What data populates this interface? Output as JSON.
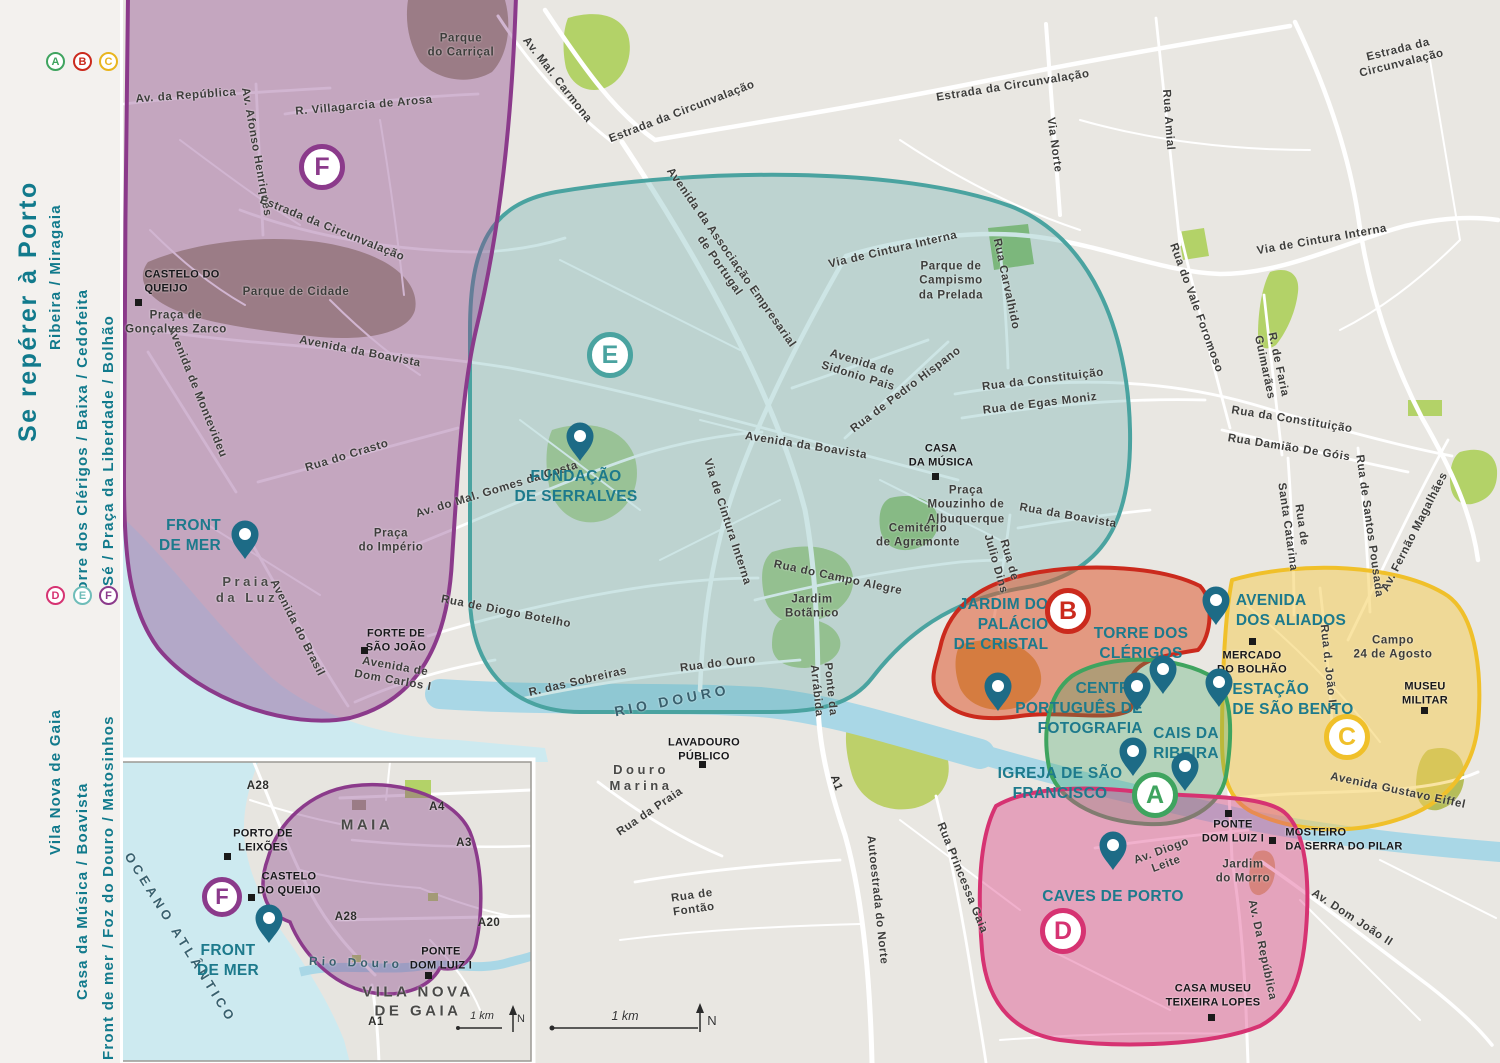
{
  "sidebar": {
    "title": "Se repérer à Porto",
    "legend_top": [
      {
        "letter": "A",
        "text": "Ribeira / Miragaia",
        "color": "#3fa45f"
      },
      {
        "letter": "B",
        "text": "Torre dos Clérigos / Baixa / Cedofeita",
        "color": "#cb2a1d"
      },
      {
        "letter": "C",
        "text": "Sé / Praça da Liberdade / Bolhão",
        "color": "#e9b51e"
      }
    ],
    "legend_bottom": [
      {
        "letter": "D",
        "text": "Vila Nova de Gaia",
        "color": "#d63372"
      },
      {
        "letter": "E",
        "text": "Casa da Música / Boavista",
        "color": "#6fbdb9"
      },
      {
        "letter": "F",
        "text": "Front de mer / Foz do Douro / Matosinhos",
        "color": "#8b3a8b"
      }
    ]
  },
  "map": {
    "colors": {
      "background": "#e9e7e2",
      "road": "#ffffff",
      "river": "#a9d7e6",
      "ocean": "#cdeaf0",
      "park_olive": "#a6a083",
      "park_green": "#b3d268",
      "pin": "#1d6b86",
      "poi_text": "#1d7a8c",
      "title_text": "#117a8c"
    },
    "zones": [
      {
        "id": "A",
        "name": "Ribeira / Miragaia",
        "color": "#3fa45f",
        "fill": "rgba(63,164,95,0.30)"
      },
      {
        "id": "B",
        "name": "Torre dos Clérigos / Baixa / Cedofeita",
        "color": "#cb2a1d",
        "fill": "rgba(222,90,50,0.55)"
      },
      {
        "id": "C",
        "name": "Sé / Praça da Liberdade / Bolhão",
        "color": "#f0c02a",
        "fill": "rgba(244,205,90,0.55)"
      },
      {
        "id": "D",
        "name": "Vila Nova de Gaia",
        "color": "#d63372",
        "fill": "rgba(221,70,135,0.42)"
      },
      {
        "id": "E",
        "name": "Casa da Música / Boavista",
        "color": "#4aa3a0",
        "fill": "rgba(74,163,160,0.28)"
      },
      {
        "id": "F",
        "name": "Front de mer / Foz do Douro / Matosinhos",
        "color": "#8b3a8b",
        "fill": "rgba(140,70,140,0.40)"
      }
    ],
    "badges": [
      {
        "zone": "F",
        "x": 322,
        "y": 167,
        "size": 46
      },
      {
        "zone": "E",
        "x": 610,
        "y": 355,
        "size": 46
      },
      {
        "zone": "B",
        "x": 1068,
        "y": 611,
        "size": 46
      },
      {
        "zone": "A",
        "x": 1155,
        "y": 795,
        "size": 46
      },
      {
        "zone": "C",
        "x": 1347,
        "y": 737,
        "size": 46
      },
      {
        "zone": "D",
        "x": 1063,
        "y": 931,
        "size": 46
      },
      {
        "zone": "F",
        "x": 222,
        "y": 897,
        "size": 40
      }
    ],
    "pins": [
      {
        "n": "pin-front-de-mer",
        "x": 245,
        "y": 560
      },
      {
        "n": "pin-fundacao-serralves",
        "x": 580,
        "y": 462
      },
      {
        "n": "pin-jardim-palacio-cristal",
        "x": 998,
        "y": 712
      },
      {
        "n": "pin-centro-portugues-fotografia",
        "x": 1137,
        "y": 712
      },
      {
        "n": "pin-torre-dos-clerigos",
        "x": 1163,
        "y": 695
      },
      {
        "n": "pin-avenida-dos-aliados",
        "x": 1216,
        "y": 626
      },
      {
        "n": "pin-estacao-sao-bento",
        "x": 1219,
        "y": 708
      },
      {
        "n": "pin-igreja-sao-francisco",
        "x": 1133,
        "y": 777
      },
      {
        "n": "pin-cais-da-ribeira",
        "x": 1185,
        "y": 792
      },
      {
        "n": "pin-caves-de-porto",
        "x": 1113,
        "y": 871
      },
      {
        "n": "pin-front-de-mer-inset",
        "x": 269,
        "y": 944
      }
    ],
    "squares": [
      {
        "n": "sq-castelo-do-queijo",
        "x": 138,
        "y": 302
      },
      {
        "n": "sq-forte-sao-joao",
        "x": 364,
        "y": 650
      },
      {
        "n": "sq-casa-da-musica",
        "x": 935,
        "y": 476
      },
      {
        "n": "sq-lavadouro-publico",
        "x": 702,
        "y": 764
      },
      {
        "n": "sq-mercado-bolhao",
        "x": 1252,
        "y": 641
      },
      {
        "n": "sq-museu-militar",
        "x": 1424,
        "y": 710
      },
      {
        "n": "sq-ponte-dom-luiz",
        "x": 1228,
        "y": 813
      },
      {
        "n": "sq-mosteiro-serra-pilar",
        "x": 1272,
        "y": 840
      },
      {
        "n": "sq-casa-museu-teixeira-lopes",
        "x": 1211,
        "y": 1017
      },
      {
        "n": "sq-porto-de-leixoes",
        "x": 227,
        "y": 856
      },
      {
        "n": "sq-castelo-queijo-inset",
        "x": 251,
        "y": 897
      },
      {
        "n": "sq-ponte-dom-luiz-inset",
        "x": 428,
        "y": 975
      }
    ],
    "labels": [
      {
        "t": "Av. Mal. Carmona",
        "x": 557,
        "y": 80,
        "r": 52
      },
      {
        "t": "Estrada da Circunvalação",
        "x": 682,
        "y": 112,
        "r": -21
      },
      {
        "t": "Estrada da Circunvalação",
        "x": 1013,
        "y": 86,
        "r": -9
      },
      {
        "t": "Estrada da\nCircunvalação",
        "x": 1400,
        "y": 57,
        "r": -14,
        "a": "center"
      },
      {
        "t": "Via Norte",
        "x": 1054,
        "y": 145,
        "r": 82
      },
      {
        "t": "Rua Amial",
        "x": 1168,
        "y": 120,
        "r": 86
      },
      {
        "t": "Via de Cintura Interna",
        "x": 1322,
        "y": 240,
        "r": -10
      },
      {
        "t": "Rua do Vale Foromoso",
        "x": 1196,
        "y": 308,
        "r": 70
      },
      {
        "t": "R. de Faria\nGuimarães",
        "x": 1271,
        "y": 366,
        "r": 78,
        "a": "center"
      },
      {
        "t": "Rua da Constituição",
        "x": 1292,
        "y": 420,
        "r": 9
      },
      {
        "t": "Rua Damião De Góis",
        "x": 1289,
        "y": 448,
        "r": 9
      },
      {
        "t": "Rua de\nSanta Catarina",
        "x": 1294,
        "y": 526,
        "r": 82,
        "a": "center"
      },
      {
        "t": "Rua de Santos Pousada",
        "x": 1369,
        "y": 526,
        "r": 82
      },
      {
        "t": "Av. Fernão Magalhães",
        "x": 1415,
        "y": 532,
        "r": -63
      },
      {
        "t": "Rua Carvalhido",
        "x": 1006,
        "y": 284,
        "r": 78
      },
      {
        "t": "Via de Cintura Interna",
        "x": 893,
        "y": 250,
        "r": -13
      },
      {
        "t": "Avenida da Associação Empresarial\nde Portugal",
        "x": 725,
        "y": 262,
        "r": 55,
        "a": "center"
      },
      {
        "t": "Avenida de\nSidonio Pais",
        "x": 860,
        "y": 370,
        "r": 17,
        "a": "center"
      },
      {
        "t": "Rua de Pedro Hispano",
        "x": 906,
        "y": 390,
        "r": -37
      },
      {
        "t": "Rua da Constituição",
        "x": 1043,
        "y": 380,
        "r": -7
      },
      {
        "t": "Rua de Egas Moniz",
        "x": 1040,
        "y": 404,
        "r": -7
      },
      {
        "t": "Avenida da Boavista",
        "x": 806,
        "y": 446,
        "r": 9
      },
      {
        "t": "Rua da Boavista",
        "x": 1068,
        "y": 516,
        "r": 10
      },
      {
        "t": "Rua de\nJulio Dins",
        "x": 1002,
        "y": 562,
        "r": 74,
        "a": "center"
      },
      {
        "t": "Via de Cintura Interna",
        "x": 727,
        "y": 522,
        "r": 72
      },
      {
        "t": "Rua do Campo Alegre",
        "x": 838,
        "y": 578,
        "r": 12
      },
      {
        "t": "R. das Sobreiras",
        "x": 578,
        "y": 682,
        "r": -13
      },
      {
        "t": "Rua do Ouro",
        "x": 718,
        "y": 664,
        "r": -7
      },
      {
        "t": "Avenida da Boavista",
        "x": 360,
        "y": 352,
        "r": 11
      },
      {
        "t": "Av. da República",
        "x": 186,
        "y": 96,
        "r": -4
      },
      {
        "t": "Av. Afonso Henriques",
        "x": 256,
        "y": 152,
        "r": 80
      },
      {
        "t": "R. Villagarcia de Arosa",
        "x": 364,
        "y": 106,
        "r": -5
      },
      {
        "t": "Estrada da Circunvalação",
        "x": 332,
        "y": 229,
        "r": 22
      },
      {
        "t": "Avenida de Montevideu",
        "x": 197,
        "y": 392,
        "r": 68
      },
      {
        "t": "Rua do Crasto",
        "x": 347,
        "y": 456,
        "r": -17
      },
      {
        "t": "Av. do Mal. Gomes da Costa",
        "x": 497,
        "y": 490,
        "r": -17
      },
      {
        "t": "Avenida do Brasil",
        "x": 297,
        "y": 628,
        "r": 63
      },
      {
        "t": "Avenida de\nDom Carlos I",
        "x": 394,
        "y": 674,
        "r": 10,
        "a": "center"
      },
      {
        "t": "Rua de Diogo Botelho",
        "x": 506,
        "y": 612,
        "r": 11
      },
      {
        "t": "Ponte da\nArrábida",
        "x": 823,
        "y": 690,
        "r": 84,
        "a": "center"
      },
      {
        "t": "Rua da Praia",
        "x": 650,
        "y": 812,
        "r": -34
      },
      {
        "t": "Rua de\nFontão",
        "x": 693,
        "y": 903,
        "r": -8,
        "a": "center"
      },
      {
        "t": "A1",
        "x": 836,
        "y": 783,
        "r": 70,
        "k": "road"
      },
      {
        "t": "Autoestrada do Norte",
        "x": 877,
        "y": 900,
        "r": 84
      },
      {
        "t": "Rua Princessa Gaia",
        "x": 962,
        "y": 878,
        "r": 68
      },
      {
        "t": "Avenida Gustavo Eiffel",
        "x": 1398,
        "y": 791,
        "r": 12
      },
      {
        "t": "Rua d. João IV",
        "x": 1328,
        "y": 668,
        "r": 84
      },
      {
        "t": "Av. Diogo\nLeite",
        "x": 1164,
        "y": 858,
        "r": -20,
        "a": "center"
      },
      {
        "t": "Av. Da República",
        "x": 1262,
        "y": 950,
        "r": 78
      },
      {
        "t": "Av. Dom João II",
        "x": 1352,
        "y": 918,
        "r": 33
      },
      {
        "t": "Parque\ndo Carriçal",
        "x": 461,
        "y": 46,
        "a": "center"
      },
      {
        "t": "Parque de Cidade",
        "x": 296,
        "y": 292
      },
      {
        "t": "Praça de\nGonçalves Zarco",
        "x": 176,
        "y": 323,
        "a": "center"
      },
      {
        "t": "Parque de\nCampismo\nda Prelada",
        "x": 951,
        "y": 281,
        "a": "center"
      },
      {
        "t": "Praça\nMouzinho de\nAlbuquerque",
        "x": 966,
        "y": 505,
        "a": "center"
      },
      {
        "t": "Cemitério\nde Agramonte",
        "x": 918,
        "y": 536,
        "a": "center"
      },
      {
        "t": "Jardim\nBotãnico",
        "x": 812,
        "y": 607,
        "a": "center"
      },
      {
        "t": "Praça\ndo Império",
        "x": 391,
        "y": 541,
        "a": "center"
      },
      {
        "t": "Campo\n24 de Agosto",
        "x": 1393,
        "y": 648,
        "a": "center"
      },
      {
        "t": "Jardim\ndo Morro",
        "x": 1243,
        "y": 872,
        "a": "center"
      },
      {
        "t": "Praia\nda Luz",
        "x": 247,
        "y": 590,
        "a": "center",
        "k": "area"
      },
      {
        "t": "Douro\nMarina",
        "x": 641,
        "y": 778,
        "a": "center",
        "k": "area"
      },
      {
        "t": "MAIA",
        "x": 367,
        "y": 826,
        "k": "area",
        "s": 15
      },
      {
        "t": "VILA NOVA\nDE GAIA",
        "x": 418,
        "y": 1002,
        "a": "center",
        "k": "area",
        "s": 15
      },
      {
        "t": "RIO DOURO",
        "x": 672,
        "y": 701,
        "r": -11,
        "k": "water",
        "s": 14
      },
      {
        "t": "Rio Douro",
        "x": 356,
        "y": 963,
        "r": 2,
        "k": "water",
        "s": 12
      },
      {
        "t": "OCEANO ATLÂNTICO",
        "x": 180,
        "y": 938,
        "r": 58,
        "k": "water"
      },
      {
        "t": "FRONT\nDE MER",
        "x": 190,
        "y": 536,
        "a": "right",
        "k": "poi",
        "n": "poi-label-front-de-mer"
      },
      {
        "t": "FUNDAÇÃO\nDE SERRALVES",
        "x": 576,
        "y": 487,
        "a": "center",
        "k": "poi",
        "n": "poi-label-fundacao-serralves"
      },
      {
        "t": "JARDIM DO\nPALÁCIO\nDE CRISTAL",
        "x": 1001,
        "y": 625,
        "a": "right",
        "k": "poi",
        "n": "poi-label-jardim-palacio-cristal"
      },
      {
        "t": "TORRE DOS\nCLÉRIGOS",
        "x": 1141,
        "y": 644,
        "a": "center",
        "k": "poi",
        "n": "poi-label-torre-dos-clerigos"
      },
      {
        "t": "CENTRO\nPORTUGUÊS DE\nFOTOGRAFIA",
        "x": 1079,
        "y": 709,
        "a": "right",
        "k": "poi",
        "n": "poi-label-centro-portugues-fotografia"
      },
      {
        "t": "CAIS DA\nRIBEIRA",
        "x": 1186,
        "y": 744,
        "a": "center",
        "k": "poi",
        "n": "poi-label-cais-da-ribeira"
      },
      {
        "t": "IGREJA DE SÃO\nFRANCISCO",
        "x": 1060,
        "y": 784,
        "a": "center",
        "k": "poi",
        "n": "poi-label-igreja-sao-francisco"
      },
      {
        "t": "AVENIDA\nDOS ALIADOS",
        "x": 1291,
        "y": 611,
        "a": "left",
        "k": "poi",
        "n": "poi-label-avenida-dos-aliados"
      },
      {
        "t": "ESTAÇÃO\nDE SÃO BENTO",
        "x": 1293,
        "y": 700,
        "a": "left",
        "k": "poi",
        "n": "poi-label-estacao-sao-bento"
      },
      {
        "t": "CAVES DE PORTO",
        "x": 1113,
        "y": 897,
        "k": "poi",
        "n": "poi-label-caves-de-porto"
      },
      {
        "t": "FRONT\nDE MER",
        "x": 228,
        "y": 961,
        "a": "center",
        "k": "poi",
        "n": "poi-label-front-de-mer-inset"
      },
      {
        "t": "CASTELO DO\nQUEIJO",
        "x": 182,
        "y": 282,
        "a": "left",
        "k": "poik"
      },
      {
        "t": "FORTE DE\nSÃO JOÃO",
        "x": 396,
        "y": 641,
        "a": "center",
        "k": "poik"
      },
      {
        "t": "CASA\nDA MÚSICA",
        "x": 941,
        "y": 456,
        "a": "center",
        "k": "poik"
      },
      {
        "t": "LAVADOURO\nPÚBLICO",
        "x": 704,
        "y": 750,
        "a": "center",
        "k": "poik"
      },
      {
        "t": "MERCADO\nDO BOLHÃO",
        "x": 1252,
        "y": 663,
        "a": "center",
        "k": "poik"
      },
      {
        "t": "MUSEU\nMILITAR",
        "x": 1425,
        "y": 694,
        "a": "center",
        "k": "poik"
      },
      {
        "t": "PONTE\nDOM LUIZ I",
        "x": 1233,
        "y": 832,
        "a": "center",
        "k": "poik"
      },
      {
        "t": "MOSTEIRO\nDA SERRA DO PILAR",
        "x": 1344,
        "y": 840,
        "a": "left",
        "k": "poik"
      },
      {
        "t": "CASA MUSEU\nTEIXEIRA LOPES",
        "x": 1213,
        "y": 996,
        "a": "center",
        "k": "poik"
      },
      {
        "t": "PORTO DE\nLEIXÕES",
        "x": 263,
        "y": 841,
        "a": "center",
        "k": "poik"
      },
      {
        "t": "CASTELO\nDO QUEIJO",
        "x": 289,
        "y": 884,
        "a": "center",
        "k": "poik"
      },
      {
        "t": "PONTE\nDOM LUIZ I",
        "x": 441,
        "y": 959,
        "a": "center",
        "k": "poik"
      },
      {
        "t": "A28",
        "x": 258,
        "y": 786,
        "k": "road"
      },
      {
        "t": "A4",
        "x": 437,
        "y": 807,
        "k": "road"
      },
      {
        "t": "A3",
        "x": 464,
        "y": 843,
        "k": "road"
      },
      {
        "t": "A28",
        "x": 346,
        "y": 917,
        "k": "road"
      },
      {
        "t": "A20",
        "x": 489,
        "y": 923,
        "k": "road"
      },
      {
        "t": "A1",
        "x": 376,
        "y": 1022,
        "k": "road"
      },
      {
        "t": "1 km",
        "x": 625,
        "y": 1017,
        "k": "scale",
        "n": "scale-label"
      },
      {
        "t": "N",
        "x": 712,
        "y": 1021,
        "k": "n",
        "n": "north-label"
      },
      {
        "t": "1 km",
        "x": 482,
        "y": 1017,
        "k": "scale",
        "s": 11,
        "n": "inset-scale-label"
      },
      {
        "t": "N",
        "x": 521,
        "y": 1020,
        "k": "n",
        "s": 11,
        "n": "inset-north-label"
      }
    ]
  }
}
